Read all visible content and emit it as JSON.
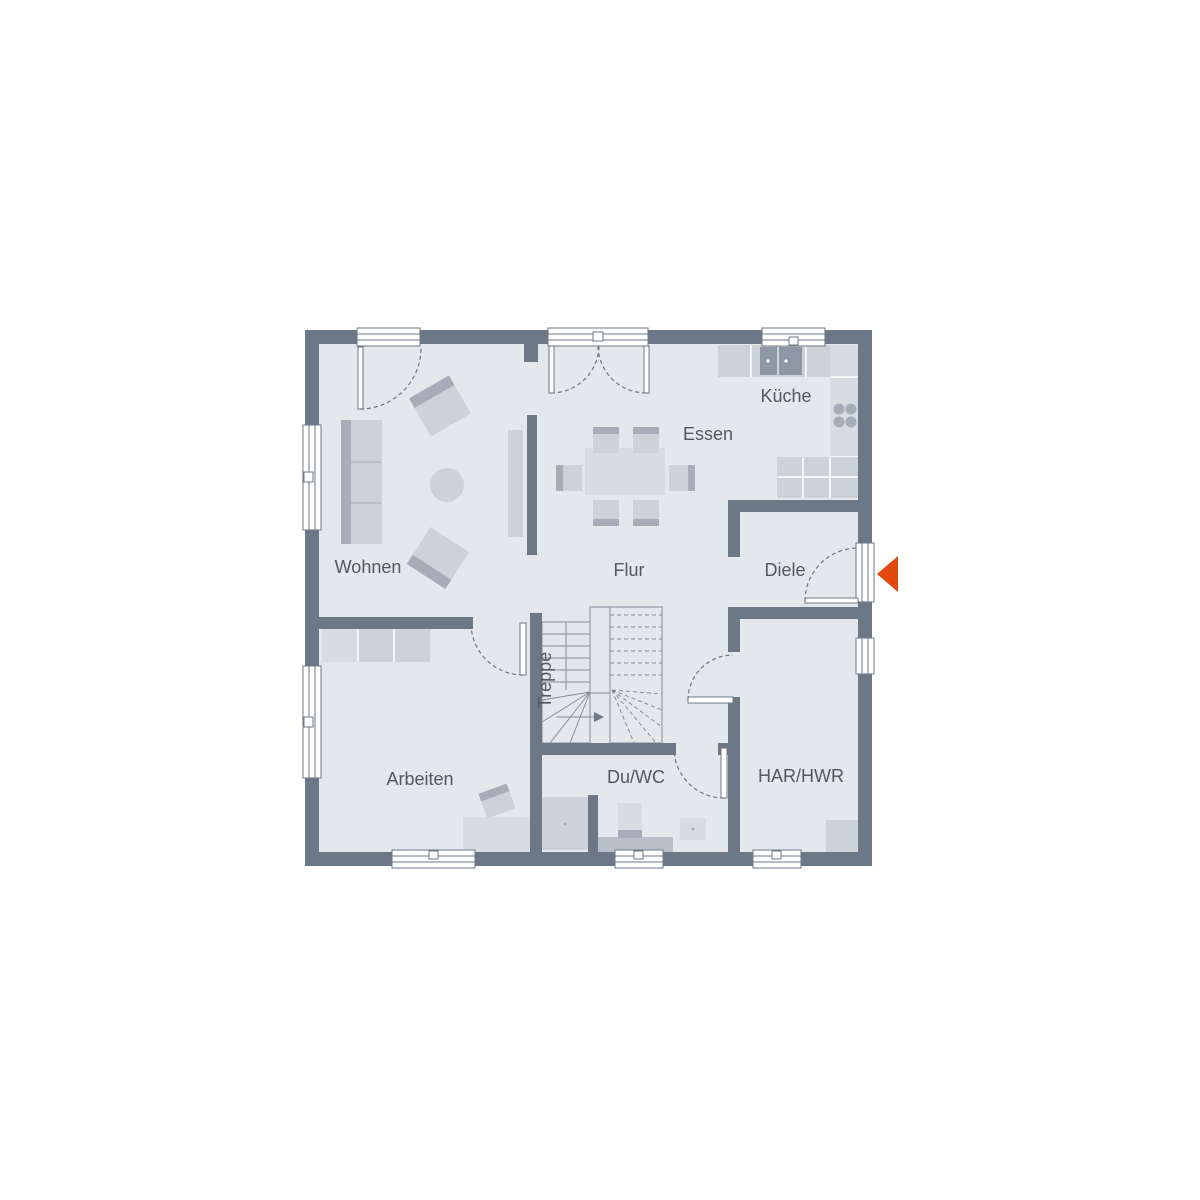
{
  "rooms": {
    "wohnen": "Wohnen",
    "essen": "Essen",
    "kueche": "Küche",
    "flur": "Flur",
    "diele": "Diele",
    "treppe": "Treppe",
    "arbeiten": "Arbeiten",
    "du_wc": "Du/WC",
    "har_hwr": "HAR/HWR"
  },
  "icons": {
    "entrance": "entrance-arrow-left"
  },
  "colors": {
    "background": "#ffffff",
    "wall": "#6c7886",
    "floor": "#e4e7ec",
    "furniture": "#cdd2d9",
    "furniture_light": "#d8dce2",
    "furniture_dark": "#a6adb8",
    "appliance": "#8e97a4",
    "counter": "#b9bfc8",
    "stair_line": "#848e9a",
    "label_text": "#4f5963",
    "entrance_arrow": "#e2490f"
  }
}
